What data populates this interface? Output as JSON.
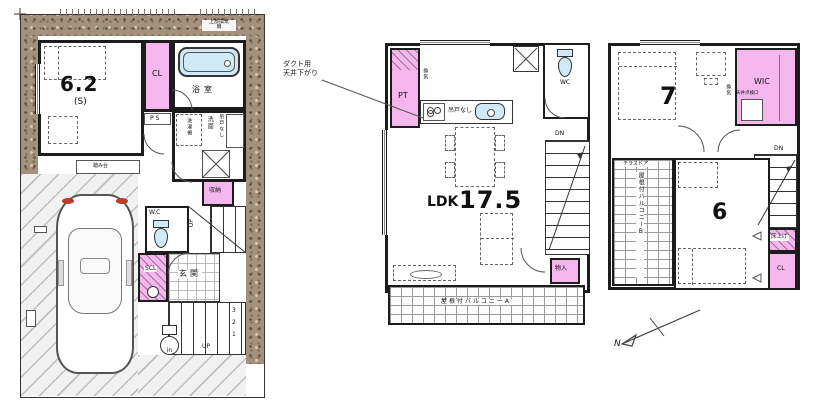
{
  "title": "間取り図（3階建て住宅 平面図）",
  "colors": {
    "accent_pink": "#f4b6ec",
    "water_blue": "#cfe9f6",
    "wall": "#1c1c1c",
    "ground_texture": "#a3917d"
  },
  "floor1": {
    "room_main_size": "6.2",
    "room_main_suffix": "(S)",
    "closet": "CL",
    "pipe_space": "P S",
    "bathroom": "浴室",
    "vent_note_line1": "上部換気",
    "vent_note_line2": "扇",
    "washer": "洗濯機",
    "washroom": "洗面",
    "no_hanging_cupboard": "吊戸なし",
    "storage": "収納",
    "up_mid": "UP",
    "wc": "W.C",
    "shoe_closet": "SCL",
    "entrance": "玄関",
    "step_stool": "踏み台",
    "stair_numbers": [
      "3",
      "2",
      "1"
    ],
    "up_entry": "UP",
    "in_mark": "in"
  },
  "floor2": {
    "annotation_line1": "ダクト用",
    "annotation_line2": "天井下がり",
    "pantry": "PT",
    "vent": "換気",
    "no_hanging_cupboard": "吊戸なし",
    "wc": "WC",
    "down": "DN",
    "ldk_label": "LDK",
    "ldk_size": "17.5",
    "storage": "物入",
    "balcony": "屋根付バルコニーA"
  },
  "floor3": {
    "room7_size": "7",
    "vent": "換気",
    "wic": "WIC",
    "inspection_hatch": "天井点検口",
    "down": "DN",
    "terrace_door": "テラスドア",
    "balcony": "屋根付バルコニーB",
    "room6_size": "6",
    "raised_floor": "床上げ",
    "closet": "CL",
    "north": "N"
  }
}
